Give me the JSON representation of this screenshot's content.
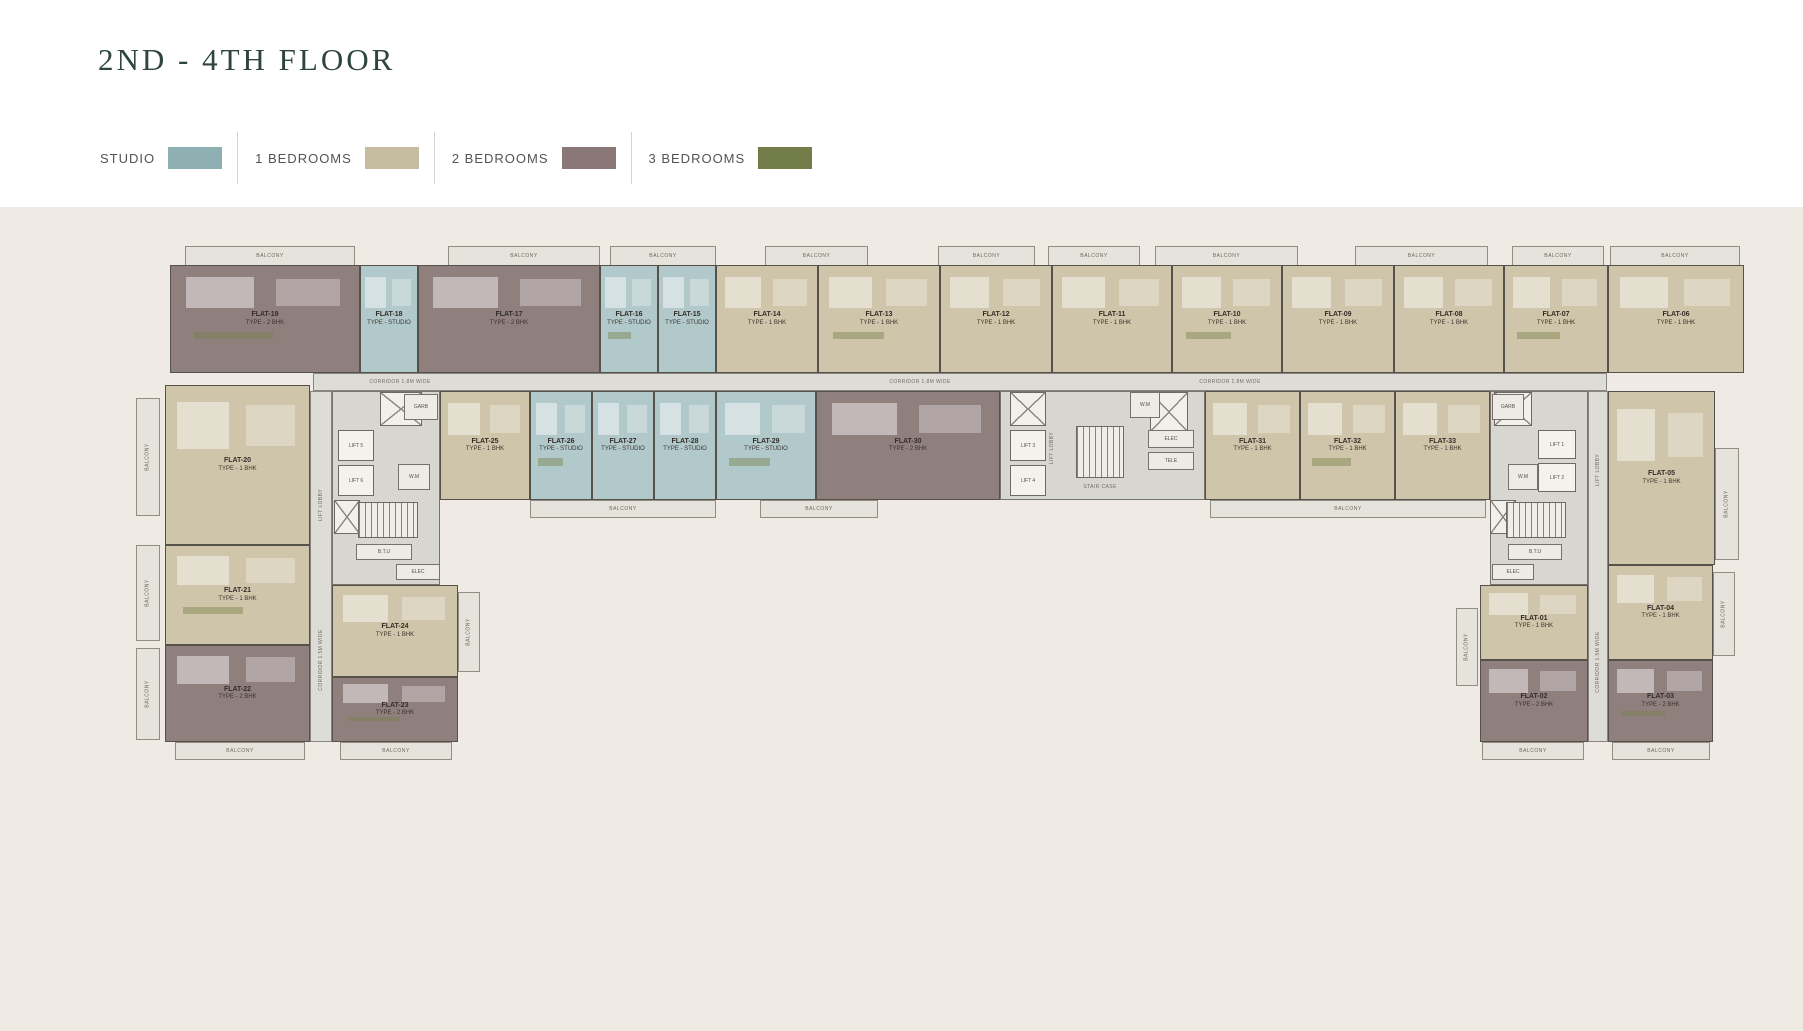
{
  "page": {
    "title": "2ND - 4TH  FLOOR"
  },
  "legend": {
    "items": [
      {
        "label": "STUDIO",
        "color": "#8fb0b2",
        "key": "studio"
      },
      {
        "label": "1 BEDROOMS",
        "color": "#c6bc9f",
        "key": "1bhk"
      },
      {
        "label": "2 BEDROOMS",
        "color": "#8a7878",
        "key": "2bhk"
      },
      {
        "label": "3 BEDROOMS",
        "color": "#727d4a",
        "key": "3bhk"
      }
    ]
  },
  "plan": {
    "canvas": {
      "w": 1803,
      "h": 1031
    },
    "palette": {
      "studio": "#b2c9cb",
      "1bhk": "#cfc5aa",
      "2bhk": "#8f7f7d",
      "3bhk": "#8a9160",
      "corridor": "#dedcd6",
      "lobby": "#d8d6d0",
      "balcony": "#e6e3dd",
      "wall": "#55524c",
      "text": "#332d28",
      "bg": "#f0eae4"
    },
    "flats": [
      {
        "n": "FLAT-19",
        "t": "TYPE - 2 BHK",
        "c": "2bhk",
        "x": 170,
        "y": 265,
        "w": 190,
        "h": 108
      },
      {
        "n": "FLAT-18",
        "t": "TYPE - STUDIO",
        "c": "studio",
        "x": 360,
        "y": 265,
        "w": 58,
        "h": 108
      },
      {
        "n": "FLAT-17",
        "t": "TYPE - 2 BHK",
        "c": "2bhk",
        "x": 418,
        "y": 265,
        "w": 182,
        "h": 108
      },
      {
        "n": "FLAT-16",
        "t": "TYPE - STUDIO",
        "c": "studio",
        "x": 600,
        "y": 265,
        "w": 58,
        "h": 108
      },
      {
        "n": "FLAT-15",
        "t": "TYPE - STUDIO",
        "c": "studio",
        "x": 658,
        "y": 265,
        "w": 58,
        "h": 108
      },
      {
        "n": "FLAT-14",
        "t": "TYPE - 1 BHK",
        "c": "1bhk",
        "x": 716,
        "y": 265,
        "w": 102,
        "h": 108
      },
      {
        "n": "FLAT-13",
        "t": "TYPE - 1 BHK",
        "c": "1bhk",
        "x": 818,
        "y": 265,
        "w": 122,
        "h": 108
      },
      {
        "n": "FLAT-12",
        "t": "TYPE - 1 BHK",
        "c": "1bhk",
        "x": 940,
        "y": 265,
        "w": 112,
        "h": 108
      },
      {
        "n": "FLAT-11",
        "t": "TYPE - 1 BHK",
        "c": "1bhk",
        "x": 1052,
        "y": 265,
        "w": 120,
        "h": 108
      },
      {
        "n": "FLAT-10",
        "t": "TYPE - 1 BHK",
        "c": "1bhk",
        "x": 1172,
        "y": 265,
        "w": 110,
        "h": 108
      },
      {
        "n": "FLAT-09",
        "t": "TYPE - 1 BHK",
        "c": "1bhk",
        "x": 1282,
        "y": 265,
        "w": 112,
        "h": 108
      },
      {
        "n": "FLAT-08",
        "t": "TYPE - 1 BHK",
        "c": "1bhk",
        "x": 1394,
        "y": 265,
        "w": 110,
        "h": 108
      },
      {
        "n": "FLAT-07",
        "t": "TYPE - 1 BHK",
        "c": "1bhk",
        "x": 1504,
        "y": 265,
        "w": 104,
        "h": 108
      },
      {
        "n": "FLAT-06",
        "t": "TYPE - 1 BHK",
        "c": "1bhk",
        "x": 1608,
        "y": 265,
        "w": 136,
        "h": 108
      },
      {
        "n": "FLAT-25",
        "t": "TYPE - 1 BHK",
        "c": "1bhk",
        "x": 440,
        "y": 391,
        "w": 90,
        "h": 109
      },
      {
        "n": "FLAT-26",
        "t": "TYPE - STUDIO",
        "c": "studio",
        "x": 530,
        "y": 391,
        "w": 62,
        "h": 109
      },
      {
        "n": "FLAT-27",
        "t": "TYPE - STUDIO",
        "c": "studio",
        "x": 592,
        "y": 391,
        "w": 62,
        "h": 109
      },
      {
        "n": "FLAT-28",
        "t": "TYPE - STUDIO",
        "c": "studio",
        "x": 654,
        "y": 391,
        "w": 62,
        "h": 109
      },
      {
        "n": "FLAT-29",
        "t": "TYPE - STUDIO",
        "c": "studio",
        "x": 716,
        "y": 391,
        "w": 100,
        "h": 109
      },
      {
        "n": "FLAT-30",
        "t": "TYPE - 2 BHK",
        "c": "2bhk",
        "x": 816,
        "y": 391,
        "w": 184,
        "h": 109
      },
      {
        "n": "FLAT-31",
        "t": "TYPE - 1 BHK",
        "c": "1bhk",
        "x": 1205,
        "y": 391,
        "w": 95,
        "h": 109
      },
      {
        "n": "FLAT-32",
        "t": "TYPE - 1 BHK",
        "c": "1bhk",
        "x": 1300,
        "y": 391,
        "w": 95,
        "h": 109
      },
      {
        "n": "FLAT-33",
        "t": "TYPE - 1 BHK",
        "c": "1bhk",
        "x": 1395,
        "y": 391,
        "w": 95,
        "h": 109
      },
      {
        "n": "FLAT-20",
        "t": "TYPE - 1 BHK",
        "c": "1bhk",
        "x": 165,
        "y": 385,
        "w": 145,
        "h": 160
      },
      {
        "n": "FLAT-21",
        "t": "TYPE - 1 BHK",
        "c": "1bhk",
        "x": 165,
        "y": 545,
        "w": 145,
        "h": 100
      },
      {
        "n": "FLAT-22",
        "t": "TYPE - 2 BHK",
        "c": "2bhk",
        "x": 165,
        "y": 645,
        "w": 145,
        "h": 97
      },
      {
        "n": "FLAT-24",
        "t": "TYPE - 1 BHK",
        "c": "1bhk",
        "x": 332,
        "y": 585,
        "w": 126,
        "h": 92
      },
      {
        "n": "FLAT-23",
        "t": "TYPE - 2 BHK",
        "c": "2bhk",
        "x": 332,
        "y": 677,
        "w": 126,
        "h": 65
      },
      {
        "n": "FLAT-05",
        "t": "TYPE - 1 BHK",
        "c": "1bhk",
        "x": 1608,
        "y": 391,
        "w": 107,
        "h": 174
      },
      {
        "n": "FLAT-04",
        "t": "TYPE - 1 BHK",
        "c": "1bhk",
        "x": 1608,
        "y": 565,
        "w": 105,
        "h": 95
      },
      {
        "n": "FLAT-03",
        "t": "TYPE - 2 BHK",
        "c": "2bhk",
        "x": 1608,
        "y": 660,
        "w": 105,
        "h": 82
      },
      {
        "n": "FLAT-01",
        "t": "TYPE - 1 BHK",
        "c": "1bhk",
        "x": 1480,
        "y": 585,
        "w": 108,
        "h": 75
      },
      {
        "n": "FLAT-02",
        "t": "TYPE - 2 BHK",
        "c": "2bhk",
        "x": 1480,
        "y": 660,
        "w": 108,
        "h": 82
      }
    ],
    "corridors": [
      {
        "x": 313,
        "y": 373,
        "w": 1294,
        "h": 18
      },
      {
        "x": 310,
        "y": 391,
        "w": 22,
        "h": 351
      },
      {
        "x": 1588,
        "y": 391,
        "w": 20,
        "h": 351
      }
    ],
    "lobbies": [
      {
        "x": 332,
        "y": 391,
        "w": 108,
        "h": 194
      },
      {
        "x": 1000,
        "y": 391,
        "w": 205,
        "h": 109
      },
      {
        "x": 1490,
        "y": 391,
        "w": 98,
        "h": 194
      }
    ],
    "balconies": [
      {
        "x": 185,
        "y": 246,
        "w": 170,
        "h": 20,
        "label": "BALCONY"
      },
      {
        "x": 448,
        "y": 246,
        "w": 152,
        "h": 20,
        "label": "BALCONY"
      },
      {
        "x": 610,
        "y": 246,
        "w": 106,
        "h": 20,
        "label": "BALCONY"
      },
      {
        "x": 765,
        "y": 246,
        "w": 103,
        "h": 20,
        "label": "BALCONY"
      },
      {
        "x": 938,
        "y": 246,
        "w": 97,
        "h": 20,
        "label": "BALCONY"
      },
      {
        "x": 1048,
        "y": 246,
        "w": 92,
        "h": 20,
        "label": "BALCONY"
      },
      {
        "x": 1155,
        "y": 246,
        "w": 143,
        "h": 20,
        "label": "BALCONY"
      },
      {
        "x": 1355,
        "y": 246,
        "w": 133,
        "h": 20,
        "label": "BALCONY"
      },
      {
        "x": 1512,
        "y": 246,
        "w": 92,
        "h": 20,
        "label": "BALCONY"
      },
      {
        "x": 1610,
        "y": 246,
        "w": 130,
        "h": 20,
        "label": "BALCONY"
      },
      {
        "x": 530,
        "y": 500,
        "w": 186,
        "h": 18,
        "label": "BALCONY"
      },
      {
        "x": 760,
        "y": 500,
        "w": 118,
        "h": 18,
        "label": "BALCONY"
      },
      {
        "x": 1210,
        "y": 500,
        "w": 276,
        "h": 18,
        "label": "BALCONY"
      },
      {
        "x": 136,
        "y": 398,
        "w": 24,
        "h": 118,
        "label": "BALCONY",
        "rot": 1
      },
      {
        "x": 136,
        "y": 545,
        "w": 24,
        "h": 96,
        "label": "BALCONY",
        "rot": 1
      },
      {
        "x": 136,
        "y": 648,
        "w": 24,
        "h": 92,
        "label": "BALCONY",
        "rot": 1
      },
      {
        "x": 458,
        "y": 592,
        "w": 22,
        "h": 80,
        "label": "BALCONY",
        "rot": 1
      },
      {
        "x": 175,
        "y": 742,
        "w": 130,
        "h": 18,
        "label": "BALCONY"
      },
      {
        "x": 340,
        "y": 742,
        "w": 112,
        "h": 18,
        "label": "BALCONY"
      },
      {
        "x": 1715,
        "y": 448,
        "w": 24,
        "h": 112,
        "label": "BALCONY",
        "rot": 1
      },
      {
        "x": 1713,
        "y": 572,
        "w": 22,
        "h": 84,
        "label": "BALCONY",
        "rot": 1
      },
      {
        "x": 1456,
        "y": 608,
        "w": 22,
        "h": 78,
        "label": "BALCONY",
        "rot": 1
      },
      {
        "x": 1482,
        "y": 742,
        "w": 102,
        "h": 18,
        "label": "BALCONY"
      },
      {
        "x": 1612,
        "y": 742,
        "w": 98,
        "h": 18,
        "label": "BALCONY"
      }
    ],
    "lifts": [
      {
        "label": "LIFT 5",
        "x": 338,
        "y": 430,
        "w": 36,
        "h": 31
      },
      {
        "label": "LIFT 6",
        "x": 338,
        "y": 465,
        "w": 36,
        "h": 31
      },
      {
        "label": "LIFT 3",
        "x": 1010,
        "y": 430,
        "w": 36,
        "h": 31
      },
      {
        "label": "LIFT 4",
        "x": 1010,
        "y": 465,
        "w": 36,
        "h": 31
      },
      {
        "label": "LIFT 1",
        "x": 1538,
        "y": 430,
        "w": 38,
        "h": 29
      },
      {
        "label": "LIFT 2",
        "x": 1538,
        "y": 463,
        "w": 38,
        "h": 29
      }
    ],
    "shafts": [
      {
        "x": 380,
        "y": 392,
        "w": 42,
        "h": 34
      },
      {
        "x": 1010,
        "y": 392,
        "w": 36,
        "h": 34
      },
      {
        "x": 1150,
        "y": 392,
        "w": 38,
        "h": 40
      },
      {
        "x": 1494,
        "y": 392,
        "w": 38,
        "h": 34
      },
      {
        "x": 334,
        "y": 500,
        "w": 26,
        "h": 34
      },
      {
        "x": 1490,
        "y": 500,
        "w": 26,
        "h": 34
      }
    ],
    "stairs": [
      {
        "x": 358,
        "y": 502,
        "w": 60,
        "h": 36
      },
      {
        "x": 1076,
        "y": 426,
        "w": 48,
        "h": 52
      },
      {
        "x": 1506,
        "y": 502,
        "w": 60,
        "h": 36
      }
    ],
    "rooms": [
      {
        "label": "GARB",
        "x": 404,
        "y": 394,
        "w": 34,
        "h": 26
      },
      {
        "label": "W.M",
        "x": 398,
        "y": 464,
        "w": 32,
        "h": 26
      },
      {
        "label": "B.T.U",
        "x": 356,
        "y": 544,
        "w": 56,
        "h": 16
      },
      {
        "label": "ELEC",
        "x": 396,
        "y": 564,
        "w": 44,
        "h": 16
      },
      {
        "label": "W.M",
        "x": 1130,
        "y": 392,
        "w": 30,
        "h": 26
      },
      {
        "label": "ELEC",
        "x": 1148,
        "y": 430,
        "w": 46,
        "h": 18
      },
      {
        "label": "TELE",
        "x": 1148,
        "y": 452,
        "w": 46,
        "h": 18
      },
      {
        "label": "GARB",
        "x": 1492,
        "y": 394,
        "w": 32,
        "h": 26
      },
      {
        "label": "W.M",
        "x": 1508,
        "y": 464,
        "w": 30,
        "h": 26
      },
      {
        "label": "B.T.U",
        "x": 1508,
        "y": 544,
        "w": 54,
        "h": 16
      },
      {
        "label": "ELEC",
        "x": 1492,
        "y": 564,
        "w": 42,
        "h": 16
      }
    ],
    "labels": [
      {
        "text": "CORRIDOR 1.8M WIDE",
        "x": 400,
        "y": 382,
        "rot": 0
      },
      {
        "text": "CORRIDOR 1.8M WIDE",
        "x": 920,
        "y": 382,
        "rot": 0
      },
      {
        "text": "CORRIDOR 1.8M WIDE",
        "x": 1230,
        "y": 382,
        "rot": 0
      },
      {
        "text": "CORRIDOR 1.5M WIDE",
        "x": 321,
        "y": 660,
        "rot": 1
      },
      {
        "text": "CORRIDOR 1.5M WIDE",
        "x": 1598,
        "y": 662,
        "rot": 1
      },
      {
        "text": "LIFT LOBBY",
        "x": 321,
        "y": 505,
        "rot": 1
      },
      {
        "text": "LIFT LOBBY",
        "x": 1052,
        "y": 448,
        "rot": 1
      },
      {
        "text": "LIFT LOBBY",
        "x": 1598,
        "y": 470,
        "rot": 1
      },
      {
        "text": "STAIR CASE",
        "x": 1100,
        "y": 487,
        "rot": 0
      }
    ]
  }
}
